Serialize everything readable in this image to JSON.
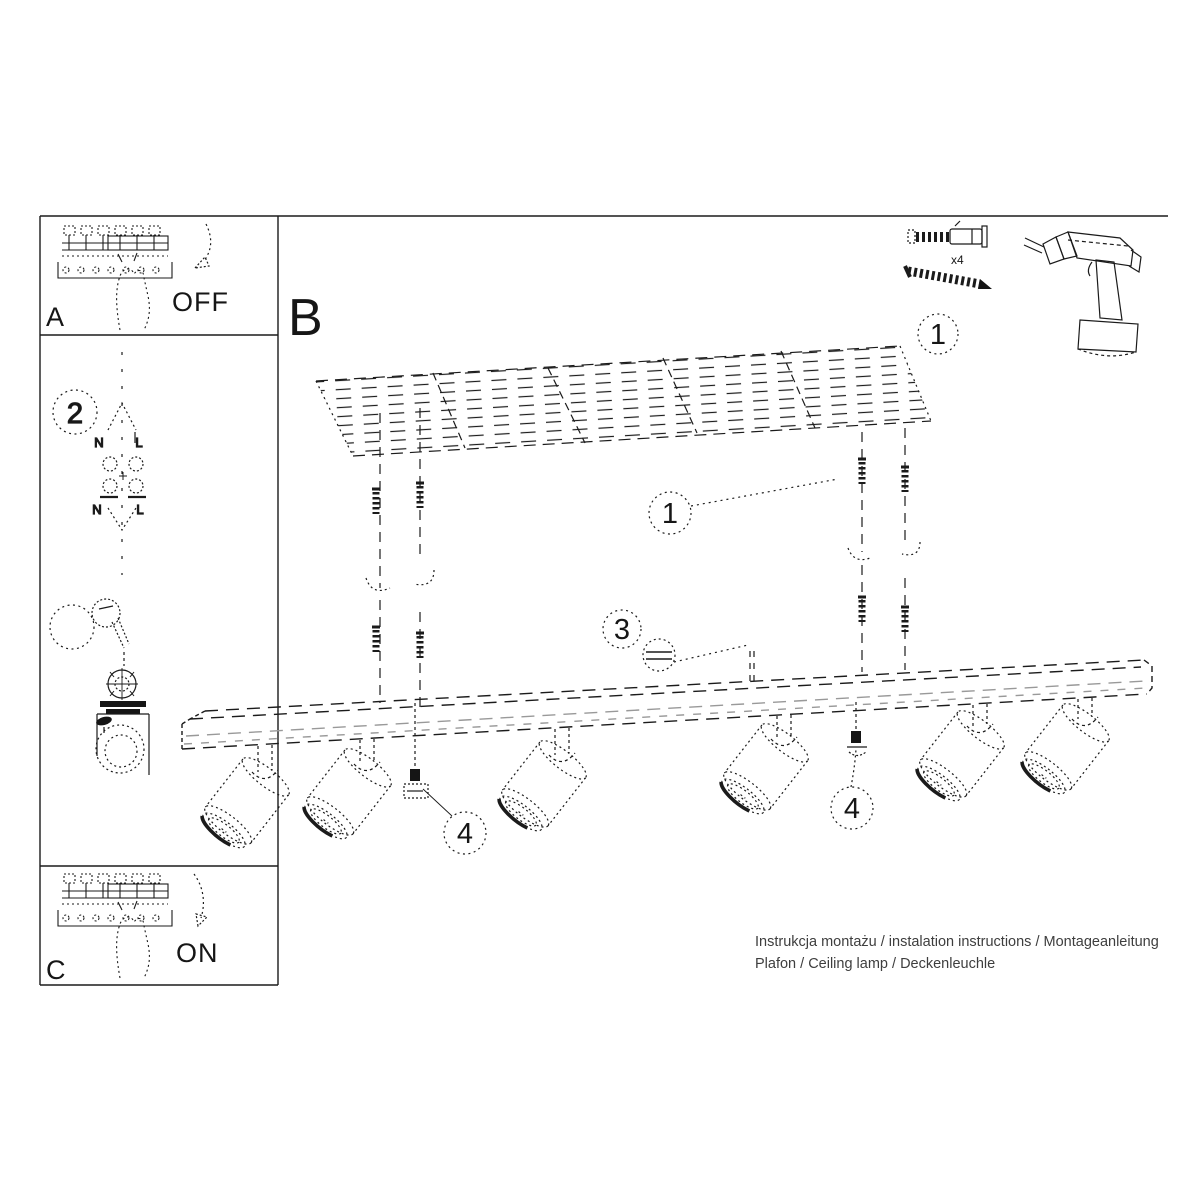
{
  "colors": {
    "paper": "#ffffff",
    "ink": "#1b1b1b",
    "muted_ink": "#999999",
    "footer_text": "#3e3e3e"
  },
  "sidebar": {
    "a": {
      "label": "A",
      "state": "OFF"
    },
    "wiring": {
      "step": "2",
      "top": {
        "n": "N",
        "l": "L"
      },
      "bottom": {
        "n": "N",
        "l": "L"
      }
    },
    "knob": {
      "step": "3"
    },
    "c": {
      "label": "C",
      "state": "ON"
    }
  },
  "main": {
    "label": "B",
    "hardware": {
      "qty": "x4"
    },
    "callouts": {
      "step1": "1",
      "step3": "3",
      "step4": "4"
    }
  },
  "footer": {
    "line1": "Instrukcja montażu / instalation instructions / Montageanleitung",
    "line2": "Plafon / Ceiling lamp / Deckenleuchle"
  }
}
